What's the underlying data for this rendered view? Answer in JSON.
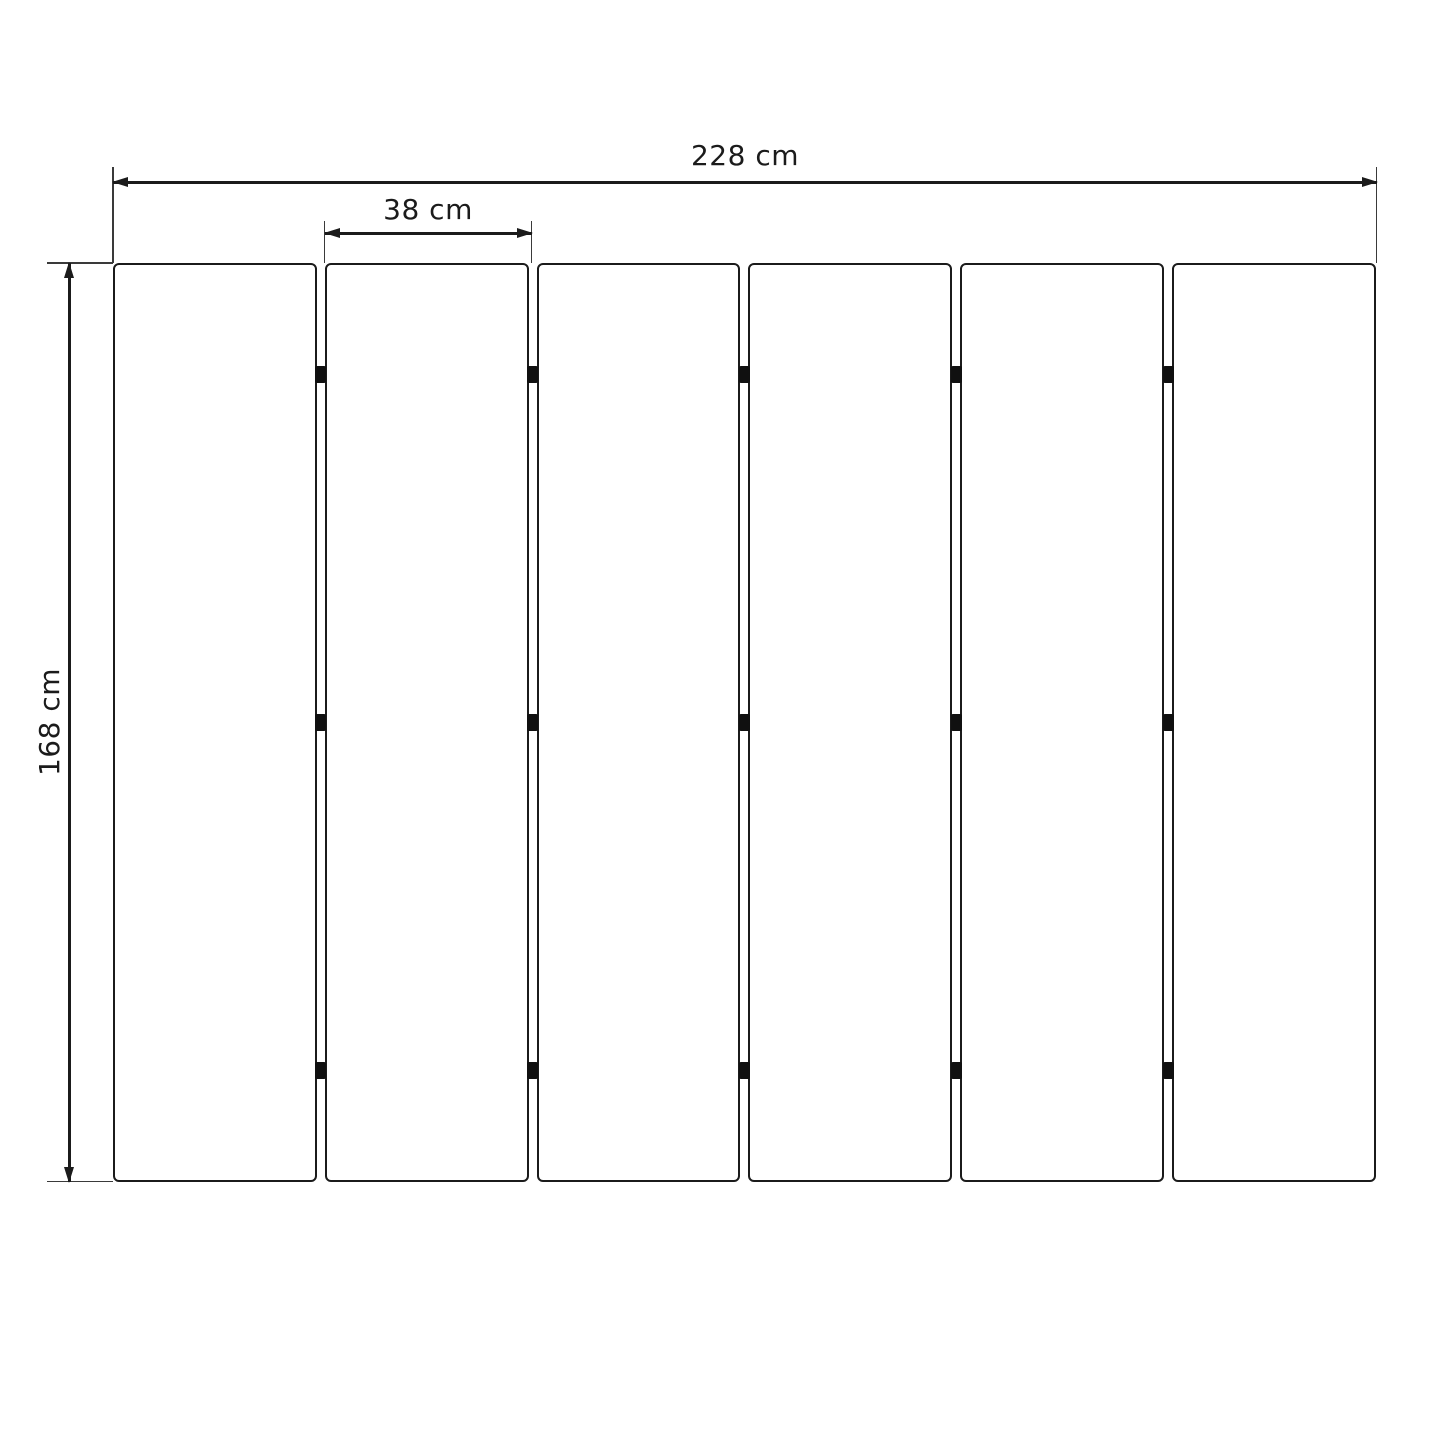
{
  "diagram": {
    "description": "Front-view technical drawing of a six-panel unit with dimension annotations",
    "unit": "cm"
  },
  "dimensions": {
    "total_width_label": "228 cm",
    "panel_width_label": "38 cm",
    "height_label": "168 cm"
  },
  "panels": {
    "count": 6,
    "gap_columns": 5,
    "connectors_per_gap": 3,
    "connector_row_fractions": [
      0.121,
      0.5,
      0.879
    ]
  },
  "colors": {
    "background": "#ffffff",
    "line": "#1b1b1b",
    "extension_line": "#3a3a3a",
    "panel_fill": "#ffffff",
    "connector": "#101010"
  }
}
